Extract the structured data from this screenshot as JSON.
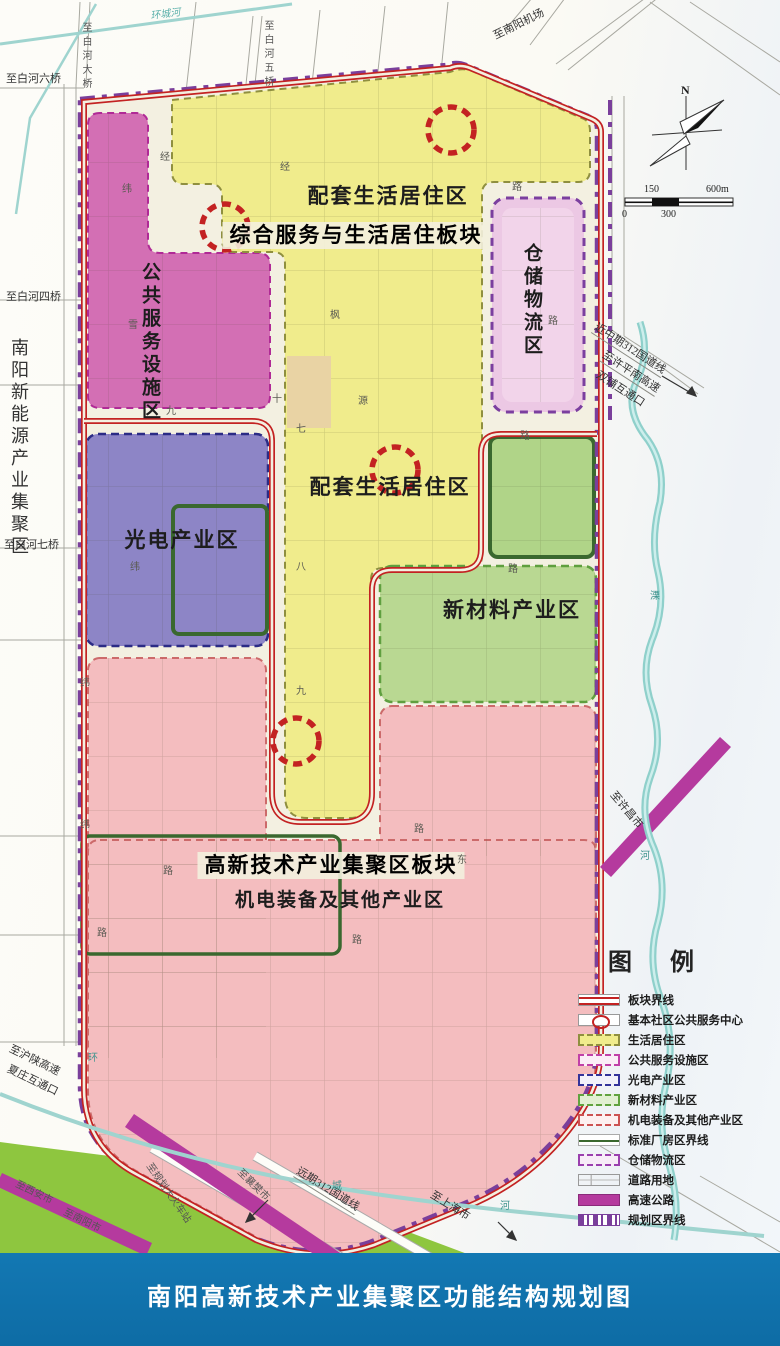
{
  "title": "南阳高新技术产业集聚区功能结构规划图",
  "compass": {
    "north": "N"
  },
  "scale": {
    "v150": "150",
    "v600": "600m",
    "v0": "0",
    "v300": "300"
  },
  "adjacent_area": "南阳新能源产业集聚区",
  "plates": {
    "service_living": "综合服务与生活居住板块",
    "hightech": "高新技术产业集聚区板块"
  },
  "zones": {
    "residential_top": "配套生活居住区",
    "residential_mid": "配套生活居住区",
    "public_service": "公共服务设施区",
    "warehouse": "仓储物流区",
    "optoelectronics": "光电产业区",
    "new_materials": "新材料产业区",
    "mechatronics": "机电装备及其他产业区"
  },
  "roads": {
    "baihe6": "至白河六桥",
    "baihe_bridge": "至白河大桥",
    "baihe5": "至白河五桥",
    "airport": "至南阳机场",
    "baihe4": "至白河四桥",
    "baihe7": "至白河七桥",
    "g312_mid": "近中期312国道线",
    "xpn_expwy": "至许平南高速",
    "shuangpu": "双铺互通口",
    "xuchang": "至许昌市",
    "hushaan": "至沪陕高速",
    "xiazhuang": "夏庄互通口",
    "xian": "至西安市",
    "nanyang": "至南阳市",
    "station": "至规划大火车站",
    "xiangfan": "至襄樊市",
    "g312_far": "远期312国道线",
    "shanghai": "至上海市",
    "ring_river": "环城河",
    "ring1": "环",
    "ring2": "城",
    "ring3": "河",
    "li1": "溧",
    "li2": "河"
  },
  "road_chars": [
    {
      "t": "经"
    },
    {
      "t": "纬"
    },
    {
      "t": "经"
    },
    {
      "t": "路"
    },
    {
      "t": "枫"
    },
    {
      "t": "源"
    },
    {
      "t": "路"
    },
    {
      "t": "十"
    },
    {
      "t": "七"
    },
    {
      "t": "雪"
    },
    {
      "t": "八"
    },
    {
      "t": "九"
    },
    {
      "t": "纬"
    },
    {
      "t": "九"
    },
    {
      "t": "纬"
    },
    {
      "t": "纬"
    },
    {
      "t": "路"
    },
    {
      "t": "路"
    },
    {
      "t": "路"
    },
    {
      "t": "东"
    },
    {
      "t": "路"
    },
    {
      "t": "路"
    },
    {
      "t": "路"
    }
  ],
  "legend": {
    "title": "图 例",
    "items": [
      {
        "label": "板块界线"
      },
      {
        "label": "基本社区公共服务中心"
      },
      {
        "label": "生活居住区"
      },
      {
        "label": "公共服务设施区"
      },
      {
        "label": "光电产业区"
      },
      {
        "label": "新材料产业区"
      },
      {
        "label": "机电装备及其他产业区"
      },
      {
        "label": "标准厂房区界线"
      },
      {
        "label": "仓储物流区"
      },
      {
        "label": "道路用地"
      },
      {
        "label": "高速公路"
      },
      {
        "label": "规划区界线"
      }
    ]
  },
  "colors": {
    "boundary_red": "#c32222",
    "planning_purple": "#7a3f9b",
    "expressway_magenta": "#b53a9e",
    "title_bar_blue": "#1378b3",
    "residential_yellow": "#f0ec8c",
    "public_service_magenta": "#d36fb4",
    "optoelectronics_purple": "#8d85c6",
    "new_materials_green": "#b7d88e",
    "mechatronics_pink": "#f4bdbf",
    "warehouse_lavender": "#ecc8e4",
    "factory_boundary_green": "#3a682f",
    "river_teal": "#8fd0cb",
    "greenway": "#8ec63f"
  }
}
